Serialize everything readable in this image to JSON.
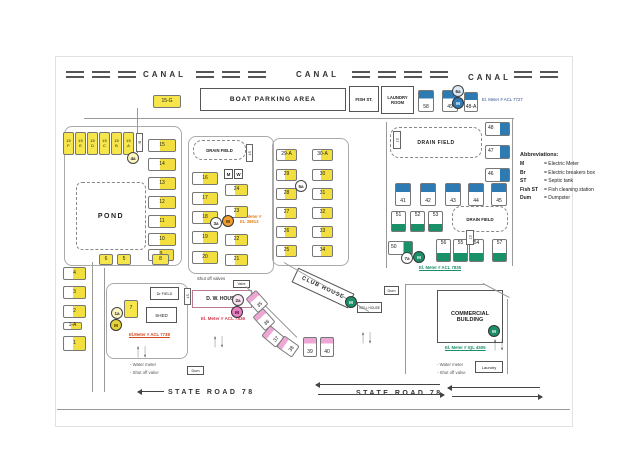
{
  "labels": {
    "canal": "CANAL",
    "state_road": "STATE ROAD 78"
  },
  "areas": {
    "boat_parking": "BOAT PARKING AREA",
    "fish_st": "FISH ST.",
    "laundry_room": "LAUNDRY\nROOM",
    "drain_field": "DRAIN FIELD",
    "pond": "POND",
    "dr_field": "Dr FIELD",
    "shed": "SHED",
    "dw_house": "D. W. HOUSE",
    "club_house": "CLUB HOUSE",
    "well_house": "WELL HOUSE",
    "commercial": "COMMERCIAL\nBUILDING",
    "dum": "Dum",
    "laundry_small": "Laundry",
    "valve": "Valve",
    "meter_box": "M",
    "water_box": "W"
  },
  "annotations": {
    "meter_7727": "El. Meter # ACL 7727",
    "meter_39913": "El. Meter #\nEL 39913",
    "meter_7835": "El. Meter # ACL 7835",
    "meter_7738": "El.Meter # ACL 7738",
    "meter_7836": "El. Meter # ACL 7836",
    "meter_4505": "El. Meter # IQL 4505",
    "shut_off": "Shut off valves",
    "water_meter_legend": "- Water meter",
    "shut_off_legend": "- Shut off valve"
  },
  "abbreviations": {
    "title": "Abbreviations:",
    "rows": [
      {
        "abbr": "M",
        "meaning": "= Electric Meter"
      },
      {
        "abbr": "Br",
        "meaning": "= Electric breakers box"
      },
      {
        "abbr": "ST",
        "meaning": "= Septic tank"
      },
      {
        "abbr": "Fish ST",
        "meaning": "= Fish cleaning station"
      },
      {
        "abbr": "Dum",
        "meaning": "= Dumpster"
      }
    ]
  },
  "colors": {
    "lot_yellow": "#f6e64b",
    "lot_blue": "#2e7bb4",
    "lot_green": "#1a9068",
    "lot_pink": "#eea7d4",
    "meter_orange": "#e0821e",
    "meter_red": "#d43a4f",
    "meter_green": "#1a9068",
    "meter_navy": "#2f4f8f",
    "meter_rust": "#d0491e"
  },
  "lots": [
    {
      "label": "15-G",
      "x": 153,
      "y": 95,
      "w": 28,
      "h": 13,
      "s": "yf"
    },
    {
      "label": "15\nF",
      "x": 63,
      "y": 132,
      "w": 11,
      "h": 23,
      "s": "yf2"
    },
    {
      "label": "15\nE",
      "x": 75,
      "y": 132,
      "w": 11,
      "h": 23,
      "s": "yf2"
    },
    {
      "label": "15\nD",
      "x": 87,
      "y": 132,
      "w": 11,
      "h": 23,
      "s": "yf2"
    },
    {
      "label": "15\nC",
      "x": 99,
      "y": 132,
      "w": 11,
      "h": 23,
      "s": "yf2"
    },
    {
      "label": "15\nB",
      "x": 111,
      "y": 132,
      "w": 11,
      "h": 23,
      "s": "yf2"
    },
    {
      "label": "15\nA",
      "x": 123,
      "y": 132,
      "w": 11,
      "h": 23,
      "s": "yf2"
    },
    {
      "label": "15",
      "x": 148,
      "y": 139,
      "w": 28,
      "h": 13,
      "s": "yr"
    },
    {
      "label": "14",
      "x": 148,
      "y": 158,
      "w": 28,
      "h": 13,
      "s": "yr"
    },
    {
      "label": "13",
      "x": 148,
      "y": 177,
      "w": 28,
      "h": 13,
      "s": "yr"
    },
    {
      "label": "12",
      "x": 148,
      "y": 196,
      "w": 28,
      "h": 13,
      "s": "yr"
    },
    {
      "label": "11",
      "x": 148,
      "y": 215,
      "w": 28,
      "h": 13,
      "s": "yr"
    },
    {
      "label": "10",
      "x": 148,
      "y": 233,
      "w": 28,
      "h": 13,
      "s": "yr"
    },
    {
      "label": "9",
      "x": 148,
      "y": 249,
      "w": 26,
      "h": 12,
      "s": "yr"
    },
    {
      "label": "16",
      "x": 192,
      "y": 172,
      "w": 26,
      "h": 13,
      "s": "yr"
    },
    {
      "label": "17",
      "x": 192,
      "y": 192,
      "w": 26,
      "h": 13,
      "s": "yr"
    },
    {
      "label": "18",
      "x": 192,
      "y": 211,
      "w": 26,
      "h": 13,
      "s": "yr"
    },
    {
      "label": "19",
      "x": 192,
      "y": 231,
      "w": 26,
      "h": 13,
      "s": "yr"
    },
    {
      "label": "20",
      "x": 192,
      "y": 251,
      "w": 26,
      "h": 13,
      "s": "yr"
    },
    {
      "label": "24",
      "x": 225,
      "y": 184,
      "w": 23,
      "h": 12,
      "s": "yr"
    },
    {
      "label": "23",
      "x": 225,
      "y": 206,
      "w": 23,
      "h": 12,
      "s": "yr"
    },
    {
      "label": "22",
      "x": 225,
      "y": 234,
      "w": 23,
      "h": 12,
      "s": "yr"
    },
    {
      "label": "21",
      "x": 225,
      "y": 254,
      "w": 23,
      "h": 12,
      "s": "yr"
    },
    {
      "label": "29-A",
      "x": 276,
      "y": 149,
      "w": 21,
      "h": 12,
      "s": "yr"
    },
    {
      "label": "29",
      "x": 276,
      "y": 169,
      "w": 21,
      "h": 12,
      "s": "yr"
    },
    {
      "label": "28",
      "x": 276,
      "y": 188,
      "w": 21,
      "h": 12,
      "s": "yr"
    },
    {
      "label": "27",
      "x": 276,
      "y": 207,
      "w": 21,
      "h": 12,
      "s": "yr"
    },
    {
      "label": "26",
      "x": 276,
      "y": 226,
      "w": 21,
      "h": 12,
      "s": "yr"
    },
    {
      "label": "25",
      "x": 276,
      "y": 245,
      "w": 21,
      "h": 12,
      "s": "yr"
    },
    {
      "label": "30-A",
      "x": 312,
      "y": 149,
      "w": 21,
      "h": 12,
      "s": "yr"
    },
    {
      "label": "30",
      "x": 312,
      "y": 169,
      "w": 21,
      "h": 12,
      "s": "yr"
    },
    {
      "label": "31",
      "x": 312,
      "y": 188,
      "w": 21,
      "h": 12,
      "s": "yr"
    },
    {
      "label": "32",
      "x": 312,
      "y": 207,
      "w": 21,
      "h": 12,
      "s": "yr"
    },
    {
      "label": "33",
      "x": 312,
      "y": 226,
      "w": 21,
      "h": 12,
      "s": "yr"
    },
    {
      "label": "34",
      "x": 312,
      "y": 245,
      "w": 21,
      "h": 12,
      "s": "yr"
    },
    {
      "label": "4",
      "x": 63,
      "y": 267,
      "w": 23,
      "h": 13,
      "s": "yr"
    },
    {
      "label": "3",
      "x": 63,
      "y": 286,
      "w": 23,
      "h": 13,
      "s": "yr"
    },
    {
      "label": "2",
      "x": 63,
      "y": 305,
      "w": 23,
      "h": 13,
      "s": "yr"
    },
    {
      "label": "1-A",
      "x": 63,
      "y": 322,
      "w": 19,
      "h": 8,
      "s": "yr"
    },
    {
      "label": "1",
      "x": 63,
      "y": 336,
      "w": 23,
      "h": 15,
      "s": "yr"
    },
    {
      "label": "6",
      "x": 99,
      "y": 254,
      "w": 14,
      "h": 11,
      "s": "yf"
    },
    {
      "label": "5",
      "x": 117,
      "y": 254,
      "w": 14,
      "h": 11,
      "s": "yf"
    },
    {
      "label": "8",
      "x": 152,
      "y": 254,
      "w": 17,
      "h": 11,
      "s": "yf"
    },
    {
      "label": "7",
      "x": 124,
      "y": 300,
      "w": 14,
      "h": 18,
      "s": "yf"
    },
    {
      "label": "58",
      "x": 418,
      "y": 90,
      "w": 16,
      "h": 22,
      "s": "bt"
    },
    {
      "label": "49",
      "x": 442,
      "y": 90,
      "w": 16,
      "h": 22,
      "s": "bt"
    },
    {
      "label": "48-A",
      "x": 464,
      "y": 92,
      "w": 14,
      "h": 20,
      "s": "bt"
    },
    {
      "label": "48",
      "x": 485,
      "y": 122,
      "w": 25,
      "h": 14,
      "s": "br"
    },
    {
      "label": "47",
      "x": 485,
      "y": 145,
      "w": 25,
      "h": 14,
      "s": "br"
    },
    {
      "label": "46",
      "x": 485,
      "y": 168,
      "w": 25,
      "h": 14,
      "s": "br"
    },
    {
      "label": "41",
      "x": 395,
      "y": 183,
      "w": 16,
      "h": 23,
      "s": "bt"
    },
    {
      "label": "42",
      "x": 420,
      "y": 183,
      "w": 16,
      "h": 23,
      "s": "bt"
    },
    {
      "label": "43",
      "x": 445,
      "y": 183,
      "w": 16,
      "h": 23,
      "s": "bt"
    },
    {
      "label": "44",
      "x": 468,
      "y": 183,
      "w": 16,
      "h": 23,
      "s": "bt"
    },
    {
      "label": "45",
      "x": 491,
      "y": 183,
      "w": 16,
      "h": 23,
      "s": "bt"
    },
    {
      "label": "51",
      "x": 391,
      "y": 211,
      "w": 15,
      "h": 21,
      "s": "gb"
    },
    {
      "label": "52",
      "x": 410,
      "y": 211,
      "w": 15,
      "h": 21,
      "s": "gb"
    },
    {
      "label": "53",
      "x": 428,
      "y": 211,
      "w": 15,
      "h": 21,
      "s": "gb"
    },
    {
      "label": "50",
      "x": 388,
      "y": 241,
      "w": 25,
      "h": 14,
      "s": "gr"
    },
    {
      "label": "56",
      "x": 436,
      "y": 239,
      "w": 15,
      "h": 23,
      "s": "gb"
    },
    {
      "label": "55",
      "x": 453,
      "y": 239,
      "w": 15,
      "h": 23,
      "s": "gb"
    },
    {
      "label": "54",
      "x": 469,
      "y": 239,
      "w": 15,
      "h": 23,
      "s": "gb"
    },
    {
      "label": "57",
      "x": 492,
      "y": 239,
      "w": 15,
      "h": 23,
      "s": "gb"
    },
    {
      "label": "35",
      "x": 250,
      "y": 292,
      "w": 14,
      "h": 19,
      "s": "pt",
      "r": -42
    },
    {
      "label": "36",
      "x": 257,
      "y": 310,
      "w": 14,
      "h": 19,
      "s": "pt",
      "r": -42
    },
    {
      "label": "37",
      "x": 266,
      "y": 327,
      "w": 14,
      "h": 19,
      "s": "pt",
      "r": -50
    },
    {
      "label": "38",
      "x": 281,
      "y": 337,
      "w": 14,
      "h": 19,
      "s": "pt",
      "r": -55
    },
    {
      "label": "39",
      "x": 303,
      "y": 337,
      "w": 14,
      "h": 20,
      "s": "pt"
    },
    {
      "label": "40",
      "x": 320,
      "y": 337,
      "w": 14,
      "h": 20,
      "s": "pt"
    }
  ],
  "markers": [
    {
      "label": "4a",
      "x": 127,
      "y": 152,
      "t": "ring",
      "bg": "#fdf6c0",
      "fg": "#222222"
    },
    {
      "label": "3a",
      "x": 210,
      "y": 217,
      "t": "ring",
      "bg": "#ffffff",
      "fg": "#222222"
    },
    {
      "label": "5a",
      "x": 295,
      "y": 180,
      "t": "ring",
      "bg": "#ffffff",
      "fg": "#222222"
    },
    {
      "label": "6a",
      "x": 452,
      "y": 85,
      "t": "ring",
      "bg": "#dc?eaf6",
      "fg": "#222222"
    },
    {
      "label": "7a",
      "x": 401,
      "y": 252,
      "t": "ring",
      "bg": "#ffffff",
      "fg": "#222222"
    },
    {
      "label": "1a",
      "x": 111,
      "y": 307,
      "t": "ring",
      "bg": "#fdf6c0",
      "fg": "#222222"
    },
    {
      "label": "2a",
      "x": 232,
      "y": 294,
      "t": "ring",
      "bg": "#fbe3f2",
      "fg": "#222222"
    },
    {
      "label": "M",
      "x": 222,
      "y": 215,
      "t": "fill",
      "bg": "#f09c2e",
      "fg": "#3a2800"
    },
    {
      "label": "M",
      "x": 452,
      "y": 97,
      "t": "fill",
      "bg": "#2e7bb4",
      "fg": "#ffffff"
    },
    {
      "label": "M",
      "x": 413,
      "y": 251,
      "t": "fill",
      "bg": "#1a9068",
      "fg": "#ffffff"
    },
    {
      "label": "M",
      "x": 110,
      "y": 319,
      "t": "fill",
      "bg": "#e8d23a",
      "fg": "#3a3000"
    },
    {
      "label": "M",
      "x": 231,
      "y": 306,
      "t": "fill",
      "bg": "#e87fc0",
      "fg": "#3a0028"
    },
    {
      "label": "M",
      "x": 345,
      "y": 296,
      "t": "fill",
      "bg": "#1a9068",
      "fg": "#ffffff"
    },
    {
      "label": "M",
      "x": 488,
      "y": 325,
      "t": "fill",
      "bg": "#1a9068",
      "fg": "#ffffff"
    }
  ],
  "st_boxes": [
    {
      "label": "ST",
      "x": 393,
      "y": 131,
      "w": 8,
      "h": 18
    },
    {
      "label": "ST",
      "x": 246,
      "y": 144,
      "w": 7,
      "h": 18
    },
    {
      "label": "ST",
      "x": 466,
      "y": 230,
      "w": 8,
      "h": 15
    },
    {
      "label": "Br",
      "x": 136,
      "y": 133,
      "w": 7,
      "h": 19
    },
    {
      "label": "ST",
      "x": 184,
      "y": 288,
      "w": 7,
      "h": 17
    }
  ]
}
